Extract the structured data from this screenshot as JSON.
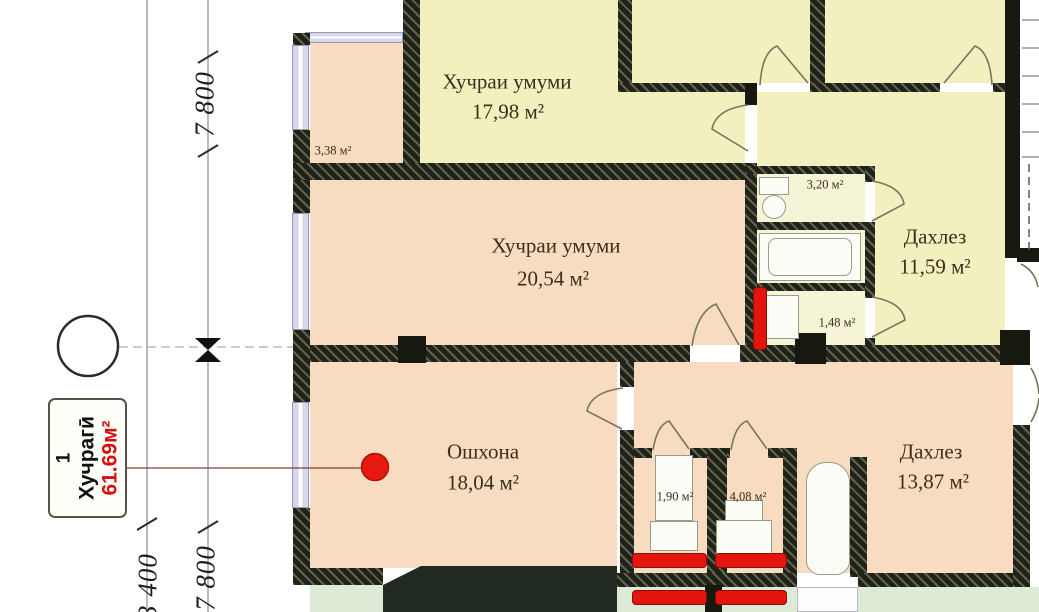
{
  "plan": {
    "rooms": {
      "living_top": {
        "name": "Хучраи умуми",
        "area": "17,98 м²"
      },
      "living_mid": {
        "name": "Хучраи умуми",
        "area": "20,54 м²"
      },
      "kitchen": {
        "name": "Ошхона",
        "area": "18,04 м²"
      },
      "hall_upper": {
        "name": "Дахлез",
        "area": "11,59 м²"
      },
      "hall_lower": {
        "name": "Дахлез",
        "area": "13,87 м²"
      },
      "storage_338": {
        "area": "3,38 м²"
      },
      "bath_320": {
        "area": "3,20 м²"
      },
      "wc_148": {
        "area": "1,48 м²"
      },
      "wc_190": {
        "area": "1,90 м²"
      },
      "bath_408": {
        "area": "4,08 м²"
      }
    },
    "dimensions": {
      "vertical_upper": "7 800",
      "vertical_lower_right": "7 800",
      "vertical_lower_left": "3 400"
    },
    "unit_label": {
      "number": "1",
      "type": "Хучрагӣ",
      "area": "61.69м²"
    },
    "colors": {
      "accent_red": "#e3150d",
      "room_yellow": "#f3f0c0",
      "room_peach": "#f8dcc1",
      "exterior_green": "#dcead6",
      "wall_dark": "#20221a"
    }
  }
}
